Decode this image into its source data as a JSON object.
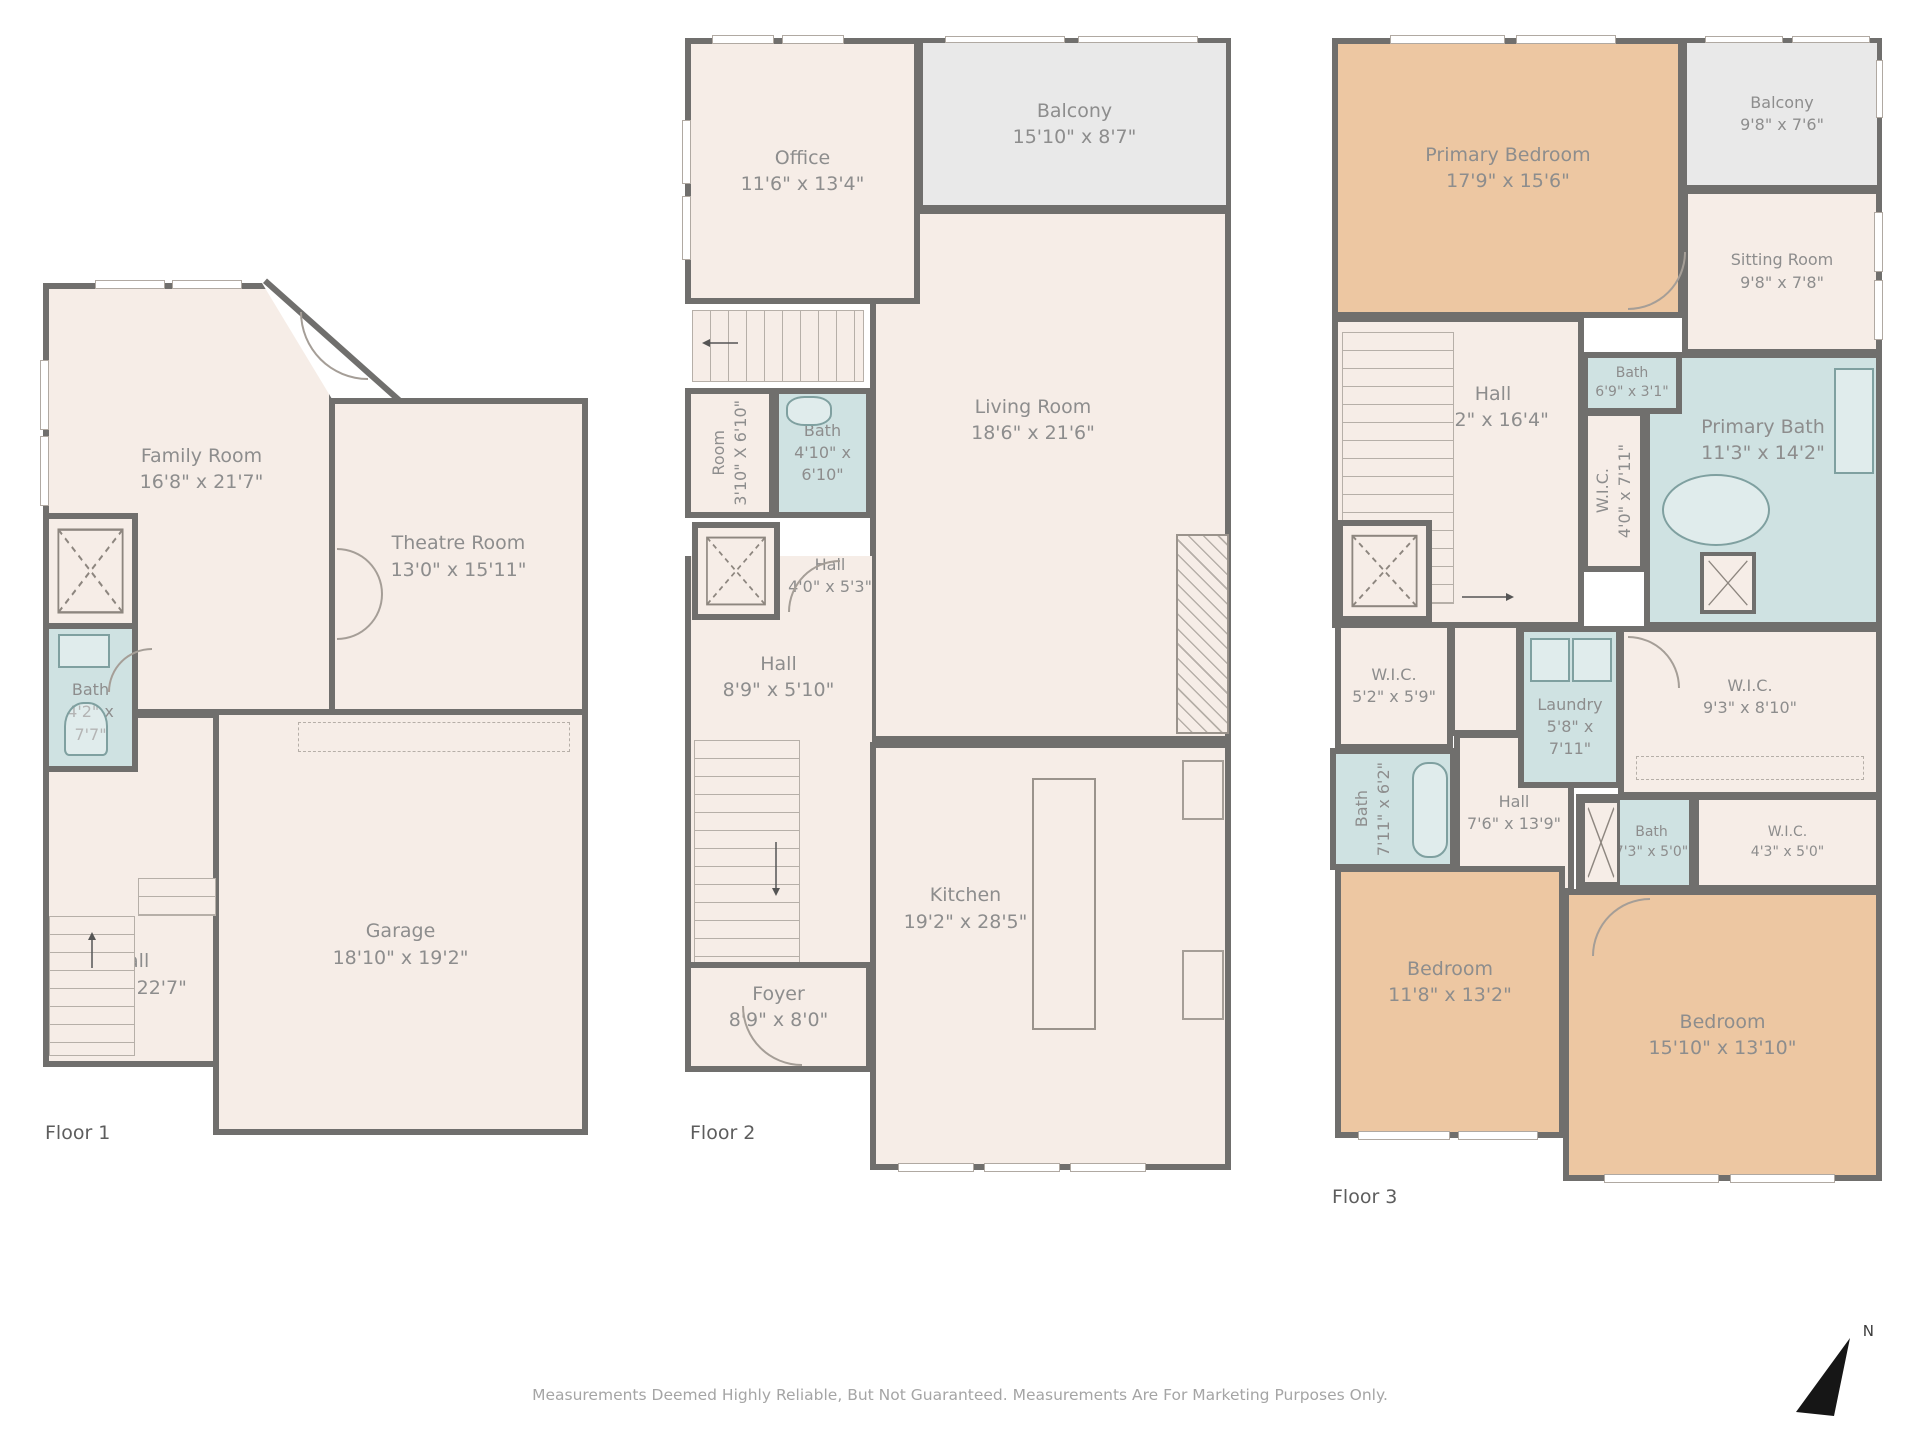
{
  "colors": {
    "wall": "#706f6d",
    "room_fill": "#f6ede7",
    "bath_fill": "#cfe2e2",
    "bedroom_fill": "#edc7a2",
    "balcony_fill": "#e9e9e9",
    "label": "#8d8d8d"
  },
  "floors": [
    {
      "label": "Floor 1",
      "rooms": [
        {
          "name": "Family Room",
          "dims": "16'8\" x 21'7\""
        },
        {
          "name": "Theatre Room",
          "dims": "13'0\" x 15'11\""
        },
        {
          "name": "Bath",
          "dims": "4'2\" x 7'7\""
        },
        {
          "name": "Hall",
          "dims": "8'7\" x 22'7\""
        },
        {
          "name": "Garage",
          "dims": "18'10\" x 19'2\""
        }
      ]
    },
    {
      "label": "Floor 2",
      "rooms": [
        {
          "name": "Office",
          "dims": "11'6\" x 13'4\""
        },
        {
          "name": "Balcony",
          "dims": "15'10\" x 8'7\""
        },
        {
          "name": "Living Room",
          "dims": "18'6\" x 21'6\""
        },
        {
          "name": "Room",
          "dims": "3'10\" X 6'10\""
        },
        {
          "name": "Bath",
          "dims": "4'10\" x 6'10\""
        },
        {
          "name": "Hall",
          "dims": "4'0\" x 5'3\""
        },
        {
          "name": "Hall",
          "dims": "8'9\" x 5'10\""
        },
        {
          "name": "Kitchen",
          "dims": "19'2\" x 28'5\""
        },
        {
          "name": "Foyer",
          "dims": "8'9\" x 8'0\""
        }
      ]
    },
    {
      "label": "Floor 3",
      "rooms": [
        {
          "name": "Primary Bedroom",
          "dims": "17'9\" x 15'6\""
        },
        {
          "name": "Balcony",
          "dims": "9'8\" x 7'6\""
        },
        {
          "name": "Sitting Room",
          "dims": "9'8\" x 7'8\""
        },
        {
          "name": "Hall",
          "dims": "8'2\" x 16'4\""
        },
        {
          "name": "Bath",
          "dims": "6'9\" x 3'1\""
        },
        {
          "name": "W.I.C.",
          "dims": "4'0\" x 7'11\""
        },
        {
          "name": "Primary Bath",
          "dims": "11'3\" x 14'2\""
        },
        {
          "name": "W.I.C.",
          "dims": "5'2\" x 5'9\""
        },
        {
          "name": "Laundry",
          "dims": "5'8\" x 7'11\""
        },
        {
          "name": "W.I.C.",
          "dims": "9'3\" x 8'10\""
        },
        {
          "name": "Bath",
          "dims": "7'11\" x 6'2\""
        },
        {
          "name": "Hall",
          "dims": "7'6\" x 13'9\""
        },
        {
          "name": "Bath",
          "dims": "7'3\" x 5'0\""
        },
        {
          "name": "W.I.C.",
          "dims": "4'3\" x 5'0\""
        },
        {
          "name": "Bedroom",
          "dims": "11'8\" x 13'2\""
        },
        {
          "name": "Bedroom",
          "dims": "15'10\" x 13'10\""
        }
      ]
    }
  ],
  "footer": {
    "disclaimer": "Measurements Deemed Highly Reliable, But Not Guaranteed. Measurements Are For Marketing Purposes Only."
  },
  "compass": {
    "label": "N"
  }
}
